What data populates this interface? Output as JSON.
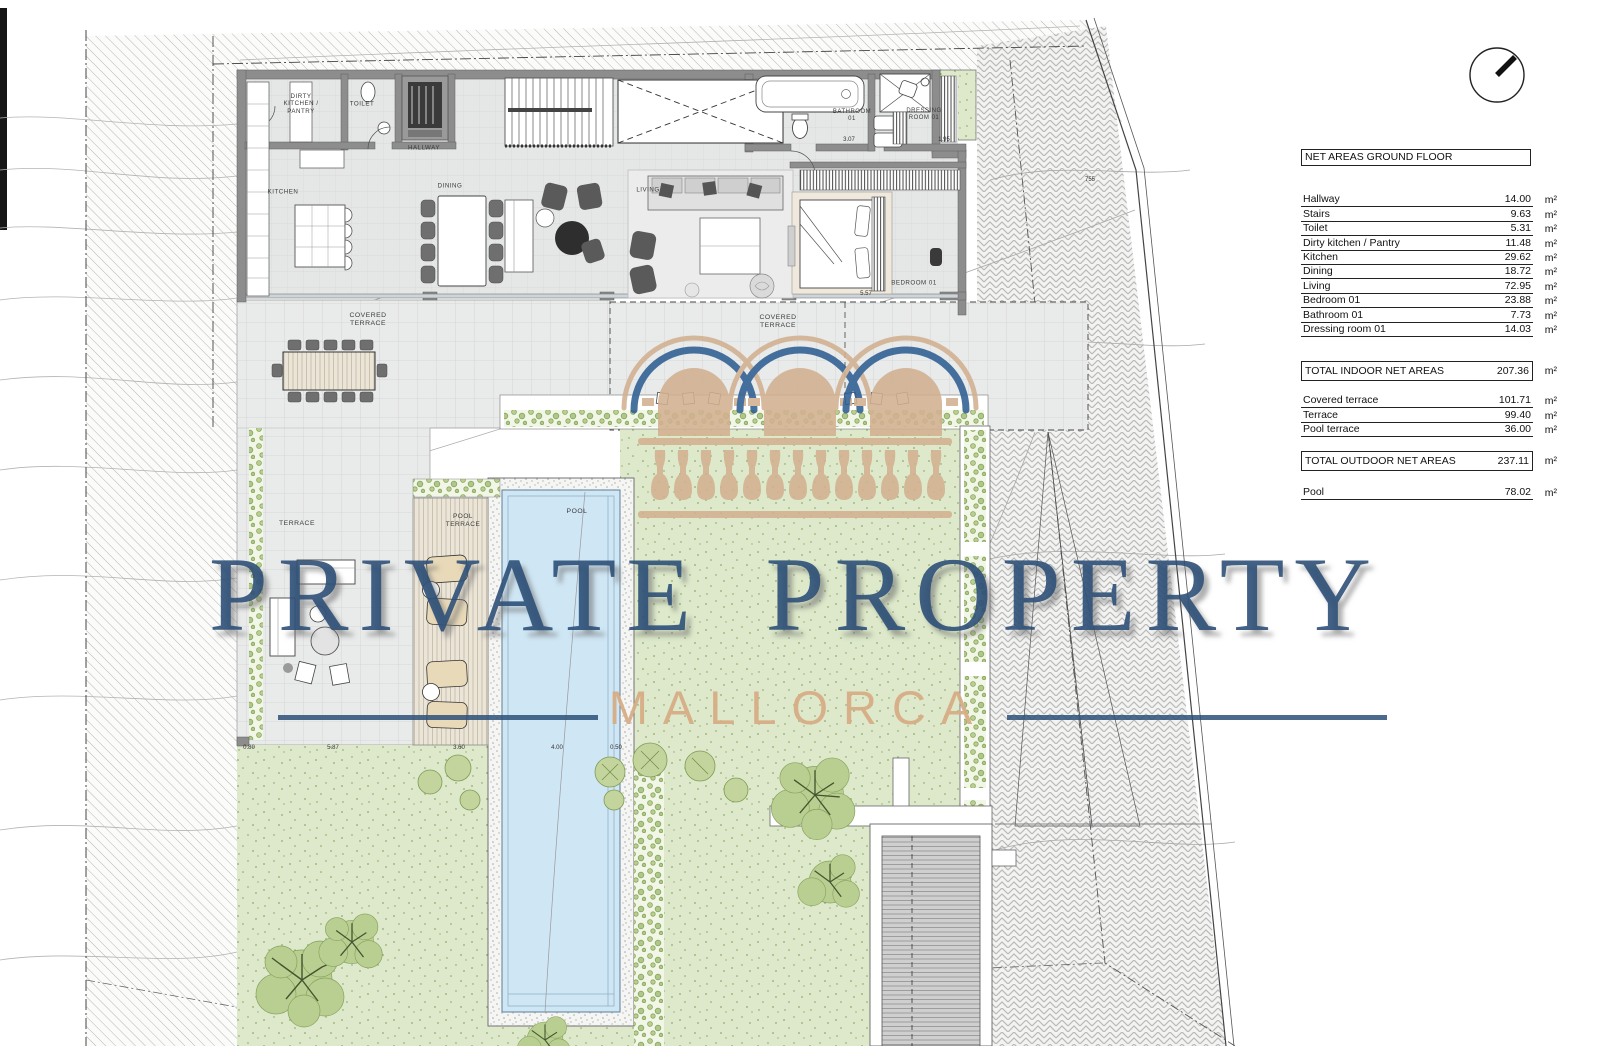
{
  "areas_table": {
    "title": "NET AREAS GROUND FLOOR",
    "unit": "m²",
    "indoor_rows": [
      {
        "label": "Hallway",
        "value": "14.00"
      },
      {
        "label": "Stairs",
        "value": "9.63"
      },
      {
        "label": "Toilet",
        "value": "5.31"
      },
      {
        "label": "Dirty kitchen / Pantry",
        "value": "11.48"
      },
      {
        "label": "Kitchen",
        "value": "29.62"
      },
      {
        "label": "Dining",
        "value": "18.72"
      },
      {
        "label": "Living",
        "value": "72.95"
      },
      {
        "label": "Bedroom 01",
        "value": "23.88"
      },
      {
        "label": "Bathroom 01",
        "value": "7.73"
      },
      {
        "label": "Dressing room 01",
        "value": "14.03"
      }
    ],
    "total_indoor": {
      "label": "TOTAL INDOOR NET AREAS",
      "value": "207.36"
    },
    "outdoor_rows": [
      {
        "label": "Covered terrace",
        "value": "101.71"
      },
      {
        "label": "Terrace",
        "value": "99.40"
      },
      {
        "label": "Pool terrace",
        "value": "36.00"
      }
    ],
    "total_outdoor": {
      "label": "TOTAL OUTDOOR NET AREAS",
      "value": "237.11"
    },
    "pool_row": {
      "label": "Pool",
      "value": "78.02"
    }
  },
  "watermark": {
    "line1": "PRIVATE PROPERTY",
    "line2": "MALLORCA",
    "accent_blue": "#2f5480",
    "accent_tan": "#d5ac86"
  },
  "icons": {
    "north_arrow": "north-arrow-compass"
  },
  "plan": {
    "labels": [
      {
        "id": "dirty-kitchen-pantry",
        "text": "DIRTY\nKITCHEN /\nPANTRY",
        "x": 301,
        "y": 104,
        "fs": 6.2
      },
      {
        "id": "toilet",
        "text": "TOILET",
        "x": 362,
        "y": 104,
        "fs": 6.2
      },
      {
        "id": "hallway",
        "text": "HALLWAY",
        "x": 424,
        "y": 148,
        "fs": 6.2
      },
      {
        "id": "kitchen",
        "text": "KITCHEN",
        "x": 283,
        "y": 192,
        "fs": 6.2
      },
      {
        "id": "dining",
        "text": "DINING",
        "x": 450,
        "y": 186,
        "fs": 6.2
      },
      {
        "id": "living",
        "text": "LIVING",
        "x": 648,
        "y": 190,
        "fs": 6.2
      },
      {
        "id": "bathroom-01",
        "text": "BATHROOM\n01",
        "x": 852,
        "y": 116,
        "fs": 6
      },
      {
        "id": "dressing-room-01",
        "text": "DRESSING\nROOM 01",
        "x": 924,
        "y": 115,
        "fs": 6
      },
      {
        "id": "bedroom-01",
        "text": "BEDROOM 01",
        "x": 914,
        "y": 283,
        "fs": 6.2
      },
      {
        "id": "covered-terrace-left",
        "text": "COVERED\nTERRACE",
        "x": 368,
        "y": 320,
        "fs": 6.8
      },
      {
        "id": "covered-terrace-right",
        "text": "COVERED\nTERRACE",
        "x": 778,
        "y": 322,
        "fs": 6.8
      },
      {
        "id": "terrace",
        "text": "TERRACE",
        "x": 297,
        "y": 524,
        "fs": 6.8
      },
      {
        "id": "pool-terrace",
        "text": "POOL\nTERRACE",
        "x": 463,
        "y": 521,
        "fs": 6.5
      },
      {
        "id": "pool",
        "text": "POOL",
        "x": 577,
        "y": 512,
        "fs": 6.8
      }
    ],
    "dimensions": [
      {
        "t": "0.80",
        "x": 249,
        "y": 748
      },
      {
        "t": "5.87",
        "x": 333,
        "y": 748
      },
      {
        "t": "3.60",
        "x": 459,
        "y": 748
      },
      {
        "t": "4.00",
        "x": 557,
        "y": 748
      },
      {
        "t": "0.50",
        "x": 616,
        "y": 748
      },
      {
        "t": "5.57",
        "x": 866,
        "y": 294
      },
      {
        "t": "3.07",
        "x": 849,
        "y": 140
      },
      {
        "t": "1.95",
        "x": 944,
        "y": 140
      },
      {
        "t": "755",
        "x": 1090,
        "y": 180
      }
    ]
  }
}
